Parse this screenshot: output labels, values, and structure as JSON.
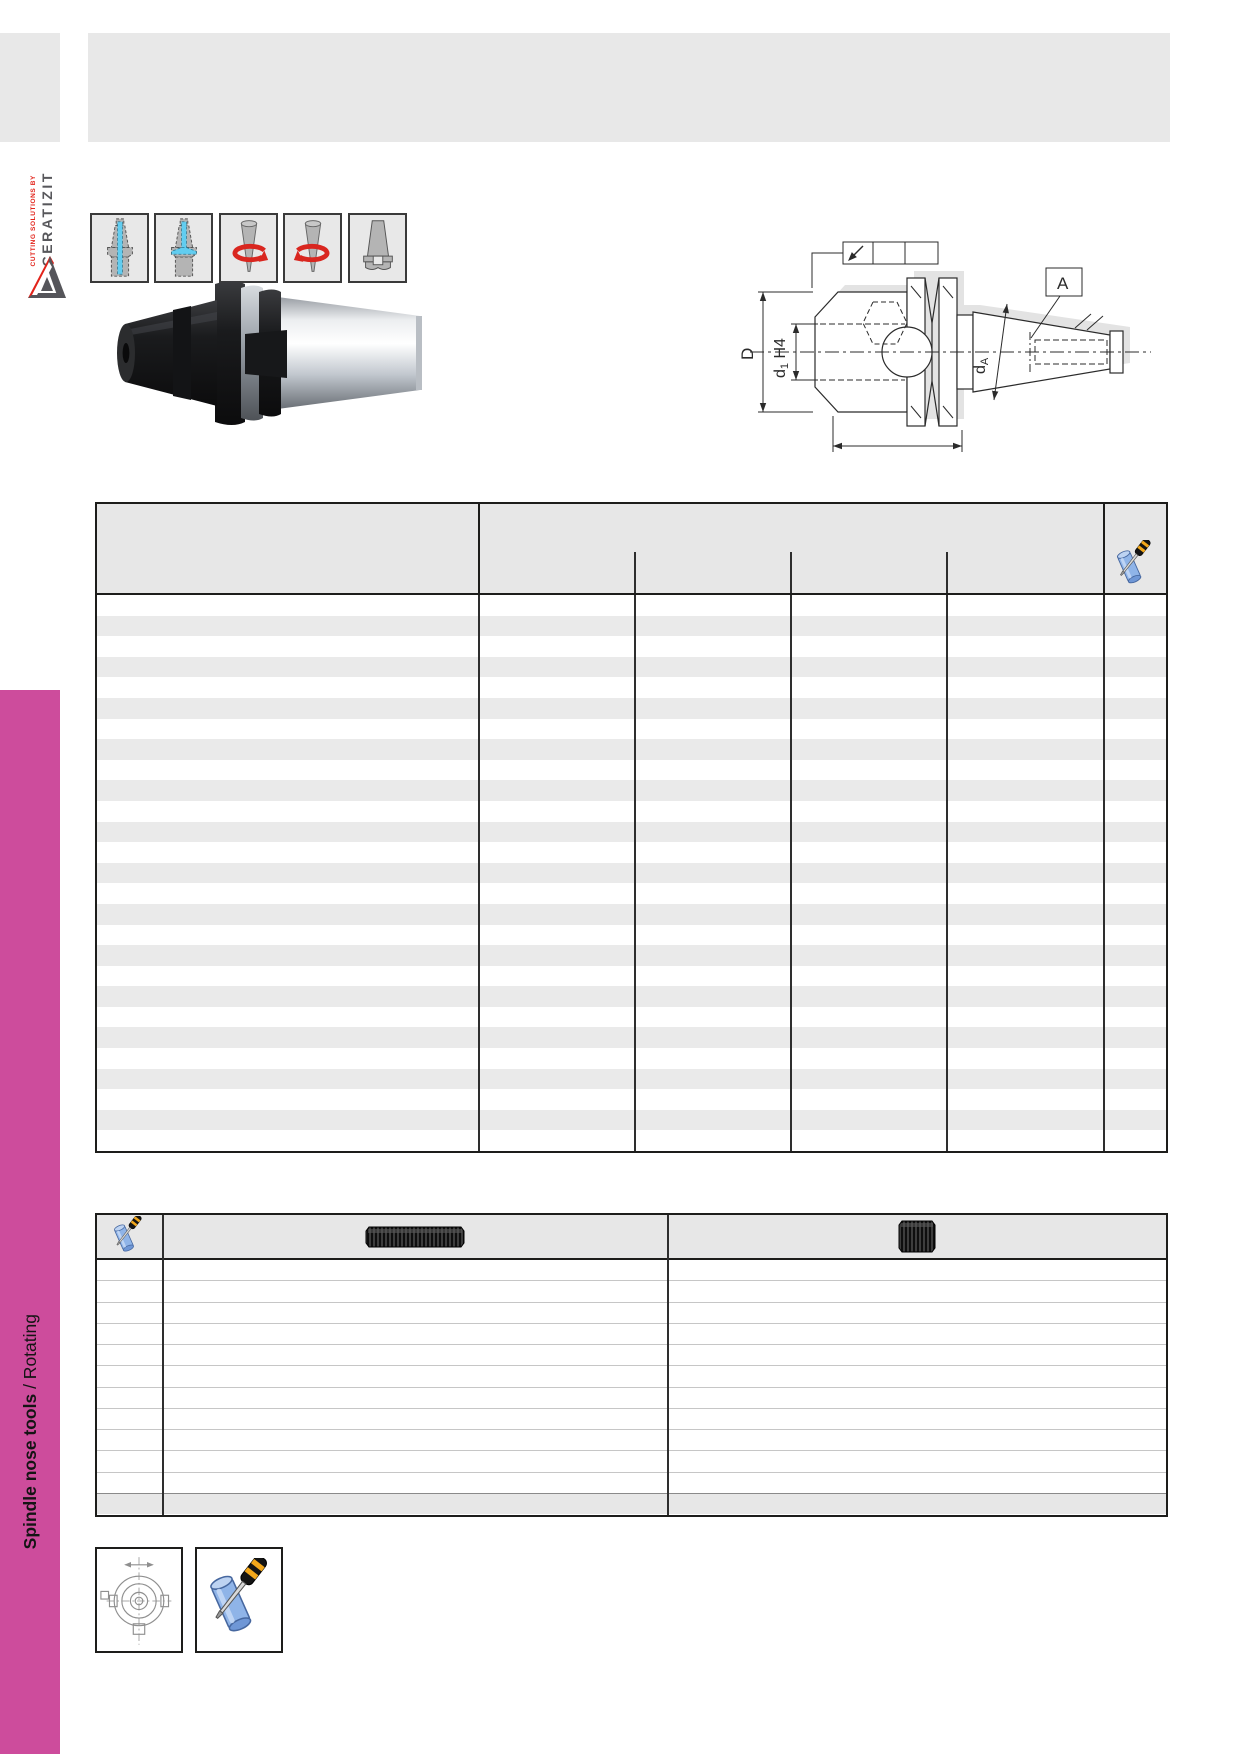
{
  "logo": {
    "tagline": "CUTTING SOLUTIONS BY",
    "brand": "CERATIZIT",
    "mark": "ceratizit-triangle-logo"
  },
  "sidebar": {
    "title_bold": "Spindle nose tools",
    "title_regular": " / Rotating",
    "accent_color": "#cd4c9c"
  },
  "feature_icons": [
    {
      "name": "coolant-central-icon"
    },
    {
      "name": "coolant-peripheral-icon"
    },
    {
      "name": "rotation-left-icon"
    },
    {
      "name": "rotation-right-icon"
    },
    {
      "name": "steep-taper-shank-icon"
    }
  ],
  "drawing": {
    "labels": {
      "D": "D",
      "d1": "d",
      "d1_sub": "1",
      "d1_fit": " H4",
      "dA": "d",
      "dA_sub": "A",
      "flag": "A"
    },
    "colors": {
      "line": "#2b2b2b",
      "shadow": "#e3e3e3"
    }
  },
  "table1": {
    "row_count": 27,
    "header_icon": "sleeve-screwdriver-icon",
    "stripe_color": "#eaeaea",
    "header_color": "#e7e7e7",
    "border_color": "#1d1d1b"
  },
  "table2": {
    "row_count": 11,
    "header_icon": "sleeve-screwdriver-icon",
    "col2_image": "threaded-stud-photo",
    "col3_image": "set-screw-photo"
  },
  "footer_boxes": [
    {
      "name": "spindle-nose-top-view-drawing"
    },
    {
      "name": "sleeve-screwdriver-icon"
    }
  ]
}
